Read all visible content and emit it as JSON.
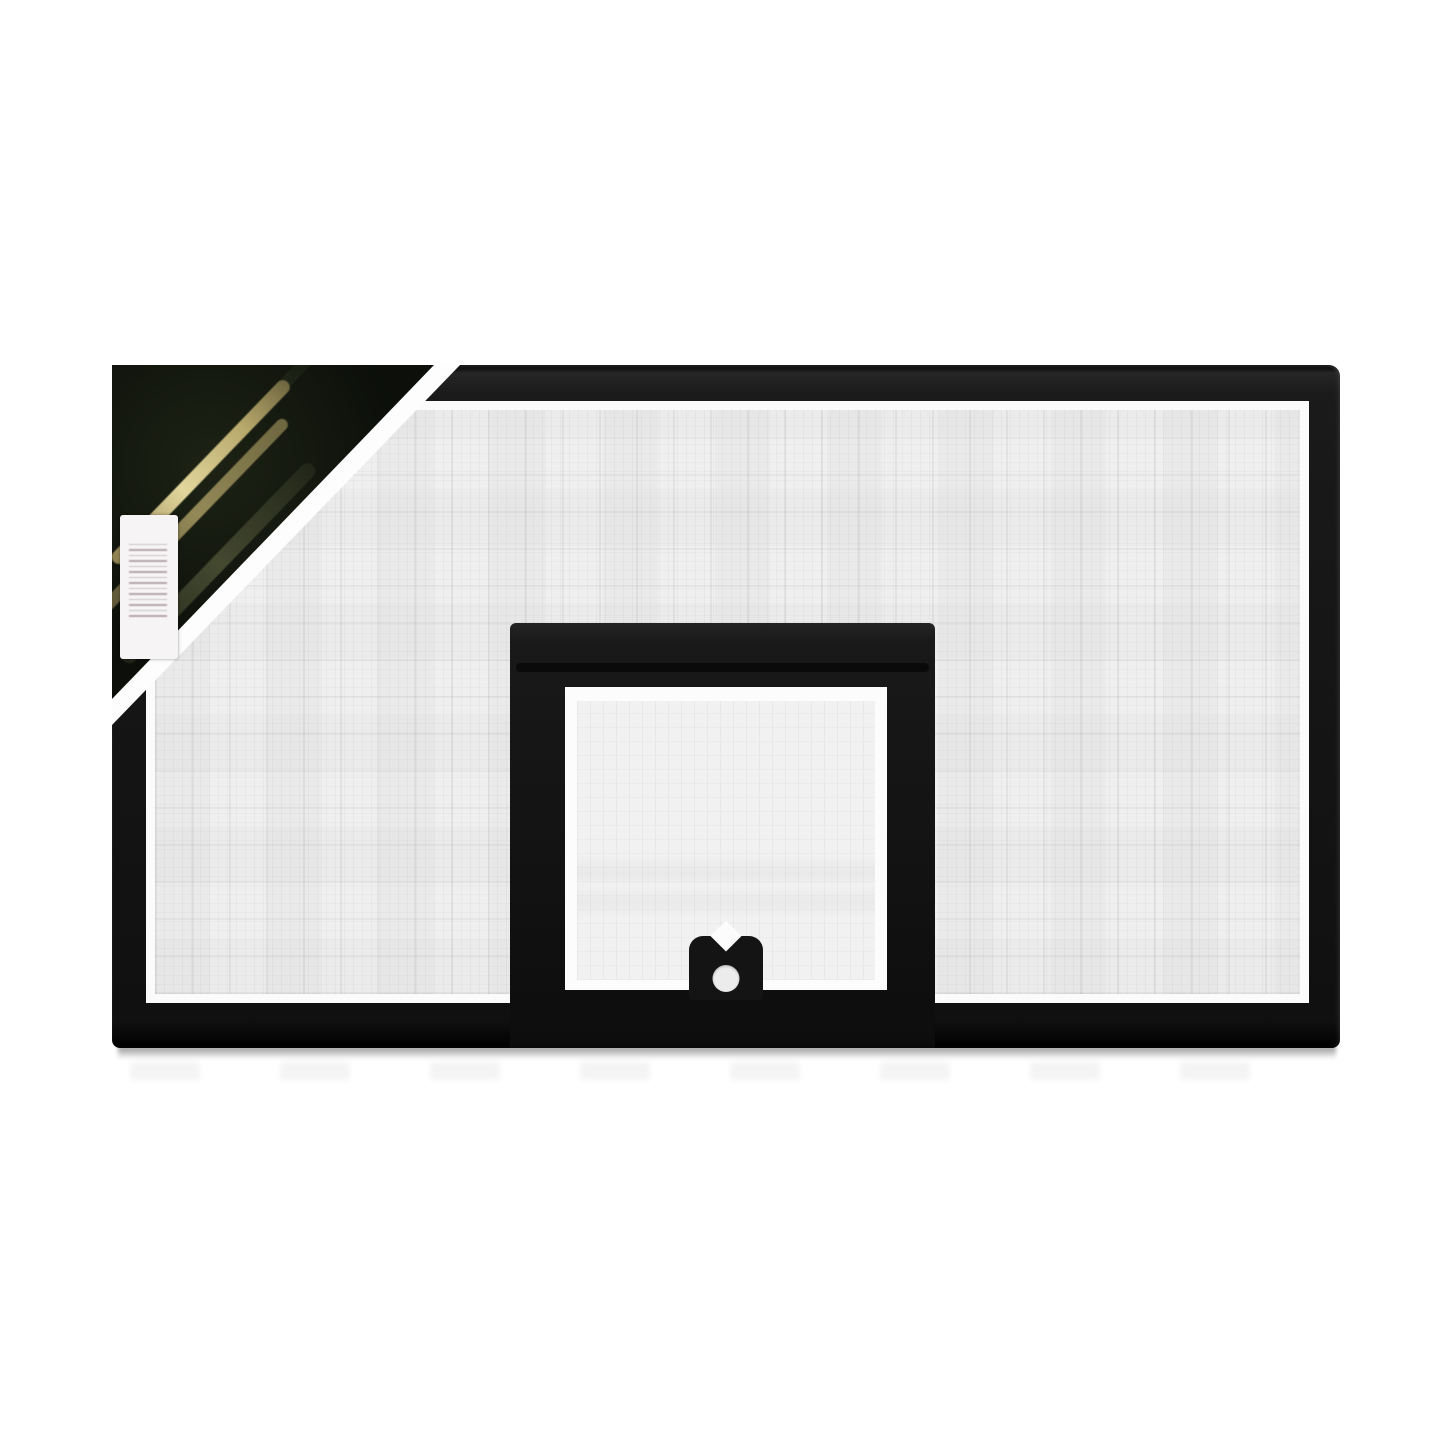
{
  "page": {
    "background": "#ffffff",
    "description": "Product photograph of a rectangular basketball backboard with a black frame, light gray gridded face, black inner shooter square open at the bottom with a rim-mount bracket hole, a black diagonal brand label across the top-left corner and a white vertical barcode sticker, casting a soft shadow below"
  },
  "board": {
    "frame_color": "#1a1a1a",
    "surface_color": "#efefef",
    "grid_line_color": "#d9d9d9",
    "margin_color": "#fbfbfb"
  },
  "inner_square": {
    "band_color": "#191919",
    "interior_color": "#fcfcfc"
  },
  "rim_bracket": {
    "color": "#141414",
    "hole_color": "#ececec"
  },
  "corner_label": {
    "background": "#0c0f0a",
    "stripe_gold": "#e2d69c",
    "stripe_olive": "#4a4f35",
    "swoosh_green": "#7fae63",
    "text_legible": "no"
  },
  "barcode_sticker": {
    "background": "#f6f4f5",
    "bars_color": "#7d6570"
  },
  "shadow": {
    "color": "rgba(0,0,0,0.45)"
  }
}
